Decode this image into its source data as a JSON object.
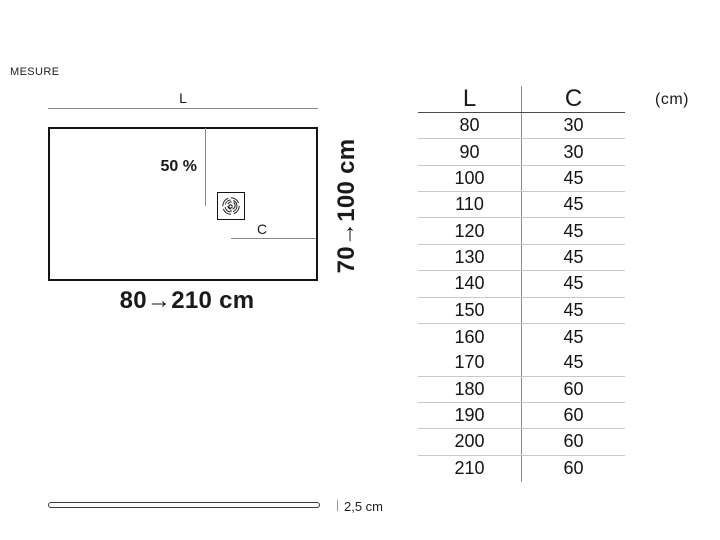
{
  "page": {
    "title": "MESURE"
  },
  "diagram": {
    "length_label": "L",
    "width_label": "C",
    "slope_label": "50 %",
    "length_range": "80→210 cm",
    "width_range": "70→100 cm",
    "thickness_label": "2,5 cm",
    "icons": {
      "drain": "drain-icon"
    }
  },
  "table": {
    "headers": [
      "L",
      "C"
    ],
    "unit": "(cm)",
    "rows": [
      {
        "l": "80",
        "c": "30"
      },
      {
        "l": "90",
        "c": "30"
      },
      {
        "l": "100",
        "c": "45"
      },
      {
        "l": "110",
        "c": "45"
      },
      {
        "l": "120",
        "c": "45"
      },
      {
        "l": "130",
        "c": "45"
      },
      {
        "l": "140",
        "c": "45"
      },
      {
        "l": "150",
        "c": "45"
      },
      {
        "l": "160",
        "c": "45"
      },
      {
        "l": "170",
        "c": "45"
      },
      {
        "l": "180",
        "c": "60"
      },
      {
        "l": "190",
        "c": "60"
      },
      {
        "l": "200",
        "c": "60"
      },
      {
        "l": "210",
        "c": "60"
      }
    ]
  },
  "colors": {
    "text": "#1a1a1a",
    "outline": "#141414",
    "dimension_line": "#8a8a8a",
    "table_header_rule": "#4a4a4a",
    "table_row_rule": "#c9c9c9"
  }
}
